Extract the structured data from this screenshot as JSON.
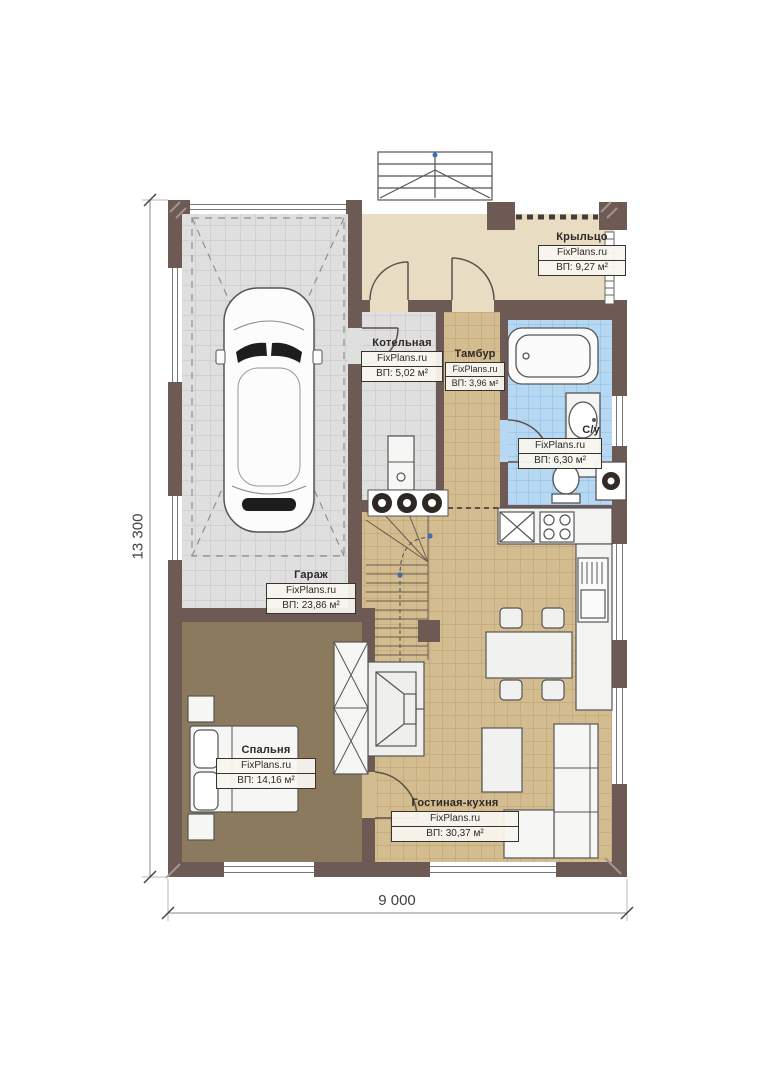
{
  "plan": {
    "brand": "FixPlans.ru",
    "dimensions": {
      "height_label": "13 300",
      "width_label": "9 000"
    },
    "rooms": [
      {
        "id": "porch",
        "name": "Крыльцо",
        "brand": "FixPlans.ru",
        "area": "ВП: 9,27 м²"
      },
      {
        "id": "boiler",
        "name": "Котельная",
        "brand": "FixPlans.ru",
        "area": "ВП: 5,02 м²"
      },
      {
        "id": "tambour",
        "name": "Тамбур",
        "brand": "FixPlans.ru",
        "area": "ВП: 3,96 м²"
      },
      {
        "id": "bath",
        "name": "С/у",
        "brand": "FixPlans.ru",
        "area": "ВП: 6,30 м²"
      },
      {
        "id": "garage",
        "name": "Гараж",
        "brand": "FixPlans.ru",
        "area": "ВП: 23,86 м²"
      },
      {
        "id": "bedroom",
        "name": "Спальня",
        "brand": "FixPlans.ru",
        "area": "ВП: 14,16 м²"
      },
      {
        "id": "living",
        "name": "Гостиная-кухня",
        "brand": "FixPlans.ru",
        "area": "ВП: 30,37 м²"
      }
    ],
    "colors": {
      "wall": "#6d5a55",
      "garage_floor": "#dfdfdf",
      "wood_floor": "#d3bd90",
      "porch_floor": "#e8dcc3",
      "bath_floor": "#b6d8f2",
      "bedroom_floor": "#8c7a5f",
      "furniture_fill": "#f5f5f3",
      "outline": "#54504b",
      "walkline_dot": "#3f6fae",
      "dimension_text": "#414141"
    },
    "fixtures": [
      "car",
      "entry-steps",
      "stairs",
      "bathtub",
      "washbasin",
      "toilet",
      "washer",
      "boiler-unit",
      "kitchen-sink",
      "stove",
      "fridge",
      "dining-table",
      "chairs",
      "coffee-table",
      "sofa",
      "bed",
      "nightstands",
      "wardrobe",
      "fireplace"
    ]
  }
}
